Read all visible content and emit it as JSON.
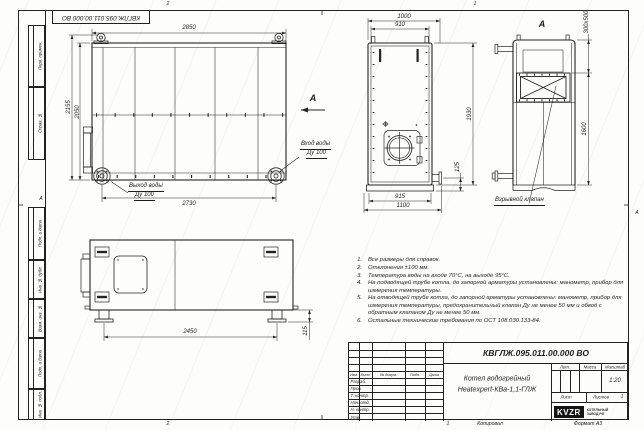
{
  "doc": {
    "number": "КВГЛЖ.095.011.00.000 ВО",
    "name_line1": "Котел водогрейный",
    "name_line2": "Heatexpert-КВа-1,1-ГЛЖ",
    "scale_value": "1:20",
    "sheets_value": "1",
    "format": "Формат А3",
    "copied": "Копировал",
    "org_logo": "KVZR",
    "org_line1": "КОТЕЛЬНЫЙ",
    "org_line2": "ЗАВОД.РФ"
  },
  "title_block": {
    "lit_label": "Лит.",
    "mass_label": "Масса",
    "scale_label": "Масштаб",
    "sheet_label": "Лист",
    "sheets_label": "Листов",
    "cols": {
      "izm": "Изм.",
      "list": "Лист",
      "doc": "№ докум.",
      "sign": "Подп.",
      "date": "Дата"
    },
    "rows": {
      "r1": "Разраб.",
      "r2": "Пров.",
      "r3": "Т. контр.",
      "r4": "Нач. отд.",
      "r5": "Н. контр.",
      "r6": "Утв."
    }
  },
  "frame": {
    "stamp_number": "КВГЛЖ.095.011.00.000 ВО",
    "zone_top_2": "2",
    "zone_top_1": "1",
    "zone_bottom_2": "2",
    "zone_bottom_1": "1",
    "zone_left": "А",
    "zone_right": "А",
    "strip": {
      "s1": "Перв. примен.",
      "s2": "Справ. №",
      "s3": "Подп. и дата",
      "s4": "Инв. № дубл.",
      "s5": "Взам. инв. №",
      "s6": "Подп. и дата",
      "s7": "Инв. № подл."
    }
  },
  "views": {
    "main": {
      "dim_top": "2850",
      "dim_left_outer": "2155",
      "dim_left_inner": "2050",
      "dim_bottom": "2730",
      "inlet_line1": "Вход воды",
      "inlet_line2": "Ду 100",
      "outlet_line1": "Выход воды",
      "outlet_line2": "Ду 100",
      "arrow_label": "А"
    },
    "front": {
      "dim_w_outer": "1000",
      "dim_w_inner": "910",
      "dim_h": "1930",
      "dim_stub": "125",
      "dim_b_inner": "915",
      "dim_b_outer": "1100"
    },
    "rear": {
      "view_label": "А",
      "dim_valve": "300x500",
      "dim_h": "1600",
      "callout": "Взрывной клапан"
    },
    "side": {
      "dim_w": "2450",
      "dim_leg": "115"
    }
  },
  "notes": {
    "n1": {
      "num": "1.",
      "text": "Все размеры для справок."
    },
    "n2": {
      "num": "2.",
      "text": "Отклонения ±100 мм."
    },
    "n3": {
      "num": "3.",
      "text": "Температура воды на входе 70°С, на выходе 95°С."
    },
    "n4": {
      "num": "4.",
      "text": "На подводящей трубе котла, до запорной арматуры установлены: манометр, прибор для измерения температуры."
    },
    "n5": {
      "num": "5.",
      "text": "На отводящей трубе котла, до запорной арматуры установлены: манометр, прибор для измерения температуры, предохранительный клапан Ду не менее 50 мм и обвод с обратным клапаном Ду не менее 50 мм."
    },
    "n6": {
      "num": "6.",
      "text": "Остальные технические требования по ОСТ 108.030.133-84."
    }
  }
}
